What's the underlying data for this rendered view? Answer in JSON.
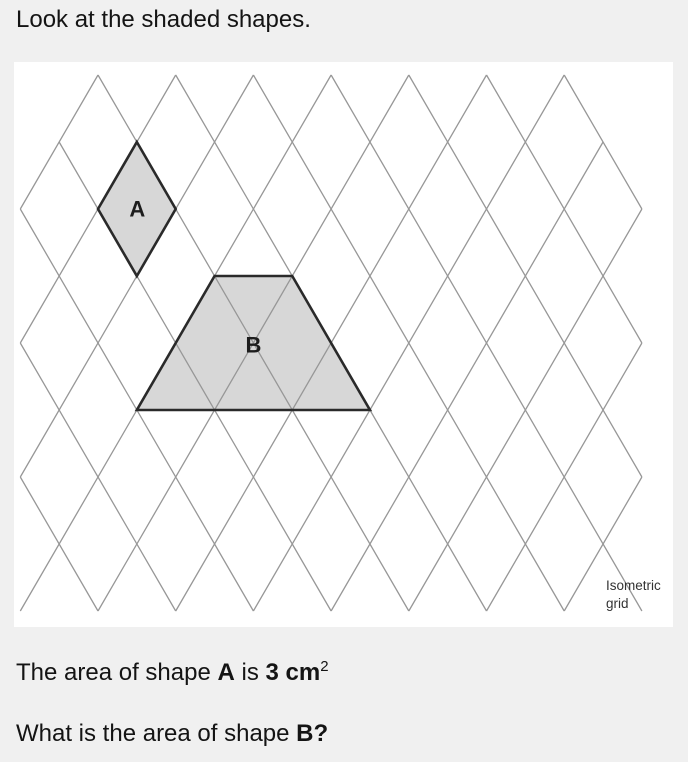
{
  "colors": {
    "page_bg": "#f0f0f0",
    "panel_bg": "#ffffff",
    "text": "#141414",
    "grid_line": "#979797",
    "shape_fill": "#d7d7d7",
    "shape_stroke": "#2a2a2a",
    "caption": "#333333"
  },
  "page": {
    "prompt": "Look at the shaded shapes."
  },
  "figure": {
    "caption": {
      "line1": "Isometric",
      "line2": "grid"
    },
    "grid": {
      "line_color": "#979797",
      "line_width": 1.3,
      "cell_width": 77.7,
      "cell_height": 134,
      "segments": [
        [
          59.15,
          142,
          331.1,
          611
        ],
        [
          20.3,
          209,
          253.4,
          611
        ],
        [
          20.3,
          343,
          175.7,
          611
        ],
        [
          20.3,
          477,
          98,
          611
        ],
        [
          98,
          75,
          408.8,
          611
        ],
        [
          175.7,
          75,
          486.5,
          611
        ],
        [
          253.4,
          75,
          564.2,
          611
        ],
        [
          331.1,
          75,
          641.9,
          611
        ],
        [
          408.8,
          75,
          641.9,
          477
        ],
        [
          486.5,
          75,
          641.9,
          343
        ],
        [
          564.2,
          75,
          641.9,
          209
        ],
        [
          603.05,
          142,
          331.1,
          611
        ],
        [
          641.9,
          209,
          408.8,
          611
        ],
        [
          641.9,
          343,
          486.5,
          611
        ],
        [
          641.9,
          477,
          564.2,
          611
        ],
        [
          98,
          75,
          20.3,
          209
        ],
        [
          175.7,
          75,
          20.3,
          343
        ],
        [
          253.4,
          75,
          20.3,
          477
        ],
        [
          331.1,
          75,
          20.3,
          611
        ],
        [
          408.8,
          75,
          98,
          611
        ],
        [
          486.5,
          75,
          175.7,
          611
        ],
        [
          564.2,
          75,
          253.4,
          611
        ]
      ]
    },
    "shapes": {
      "fill": "#d7d7d7",
      "stroke": "#2a2a2a",
      "stroke_width": 2.6,
      "label_size": 22,
      "label_color": "#1d1d1d",
      "items": [
        {
          "label": "A",
          "points": [
            [
              136.85,
              142
            ],
            [
              175.7,
              209
            ],
            [
              136.85,
              276
            ],
            [
              98,
              209
            ]
          ],
          "label_pos": [
            137.3,
            209
          ]
        },
        {
          "label": "B",
          "points": [
            [
              214.55,
              276
            ],
            [
              292.25,
              276
            ],
            [
              369.95,
              410
            ],
            [
              136.85,
              410
            ]
          ],
          "label_pos": [
            253.4,
            345
          ]
        }
      ]
    }
  },
  "question": {
    "line1_prefix": "The area of shape ",
    "line1_shape": "A",
    "line1_mid": " is ",
    "line1_value": "3 cm",
    "line1_sup": "2",
    "line2_prefix": "What is the area of shape ",
    "line2_bold": "B?"
  }
}
